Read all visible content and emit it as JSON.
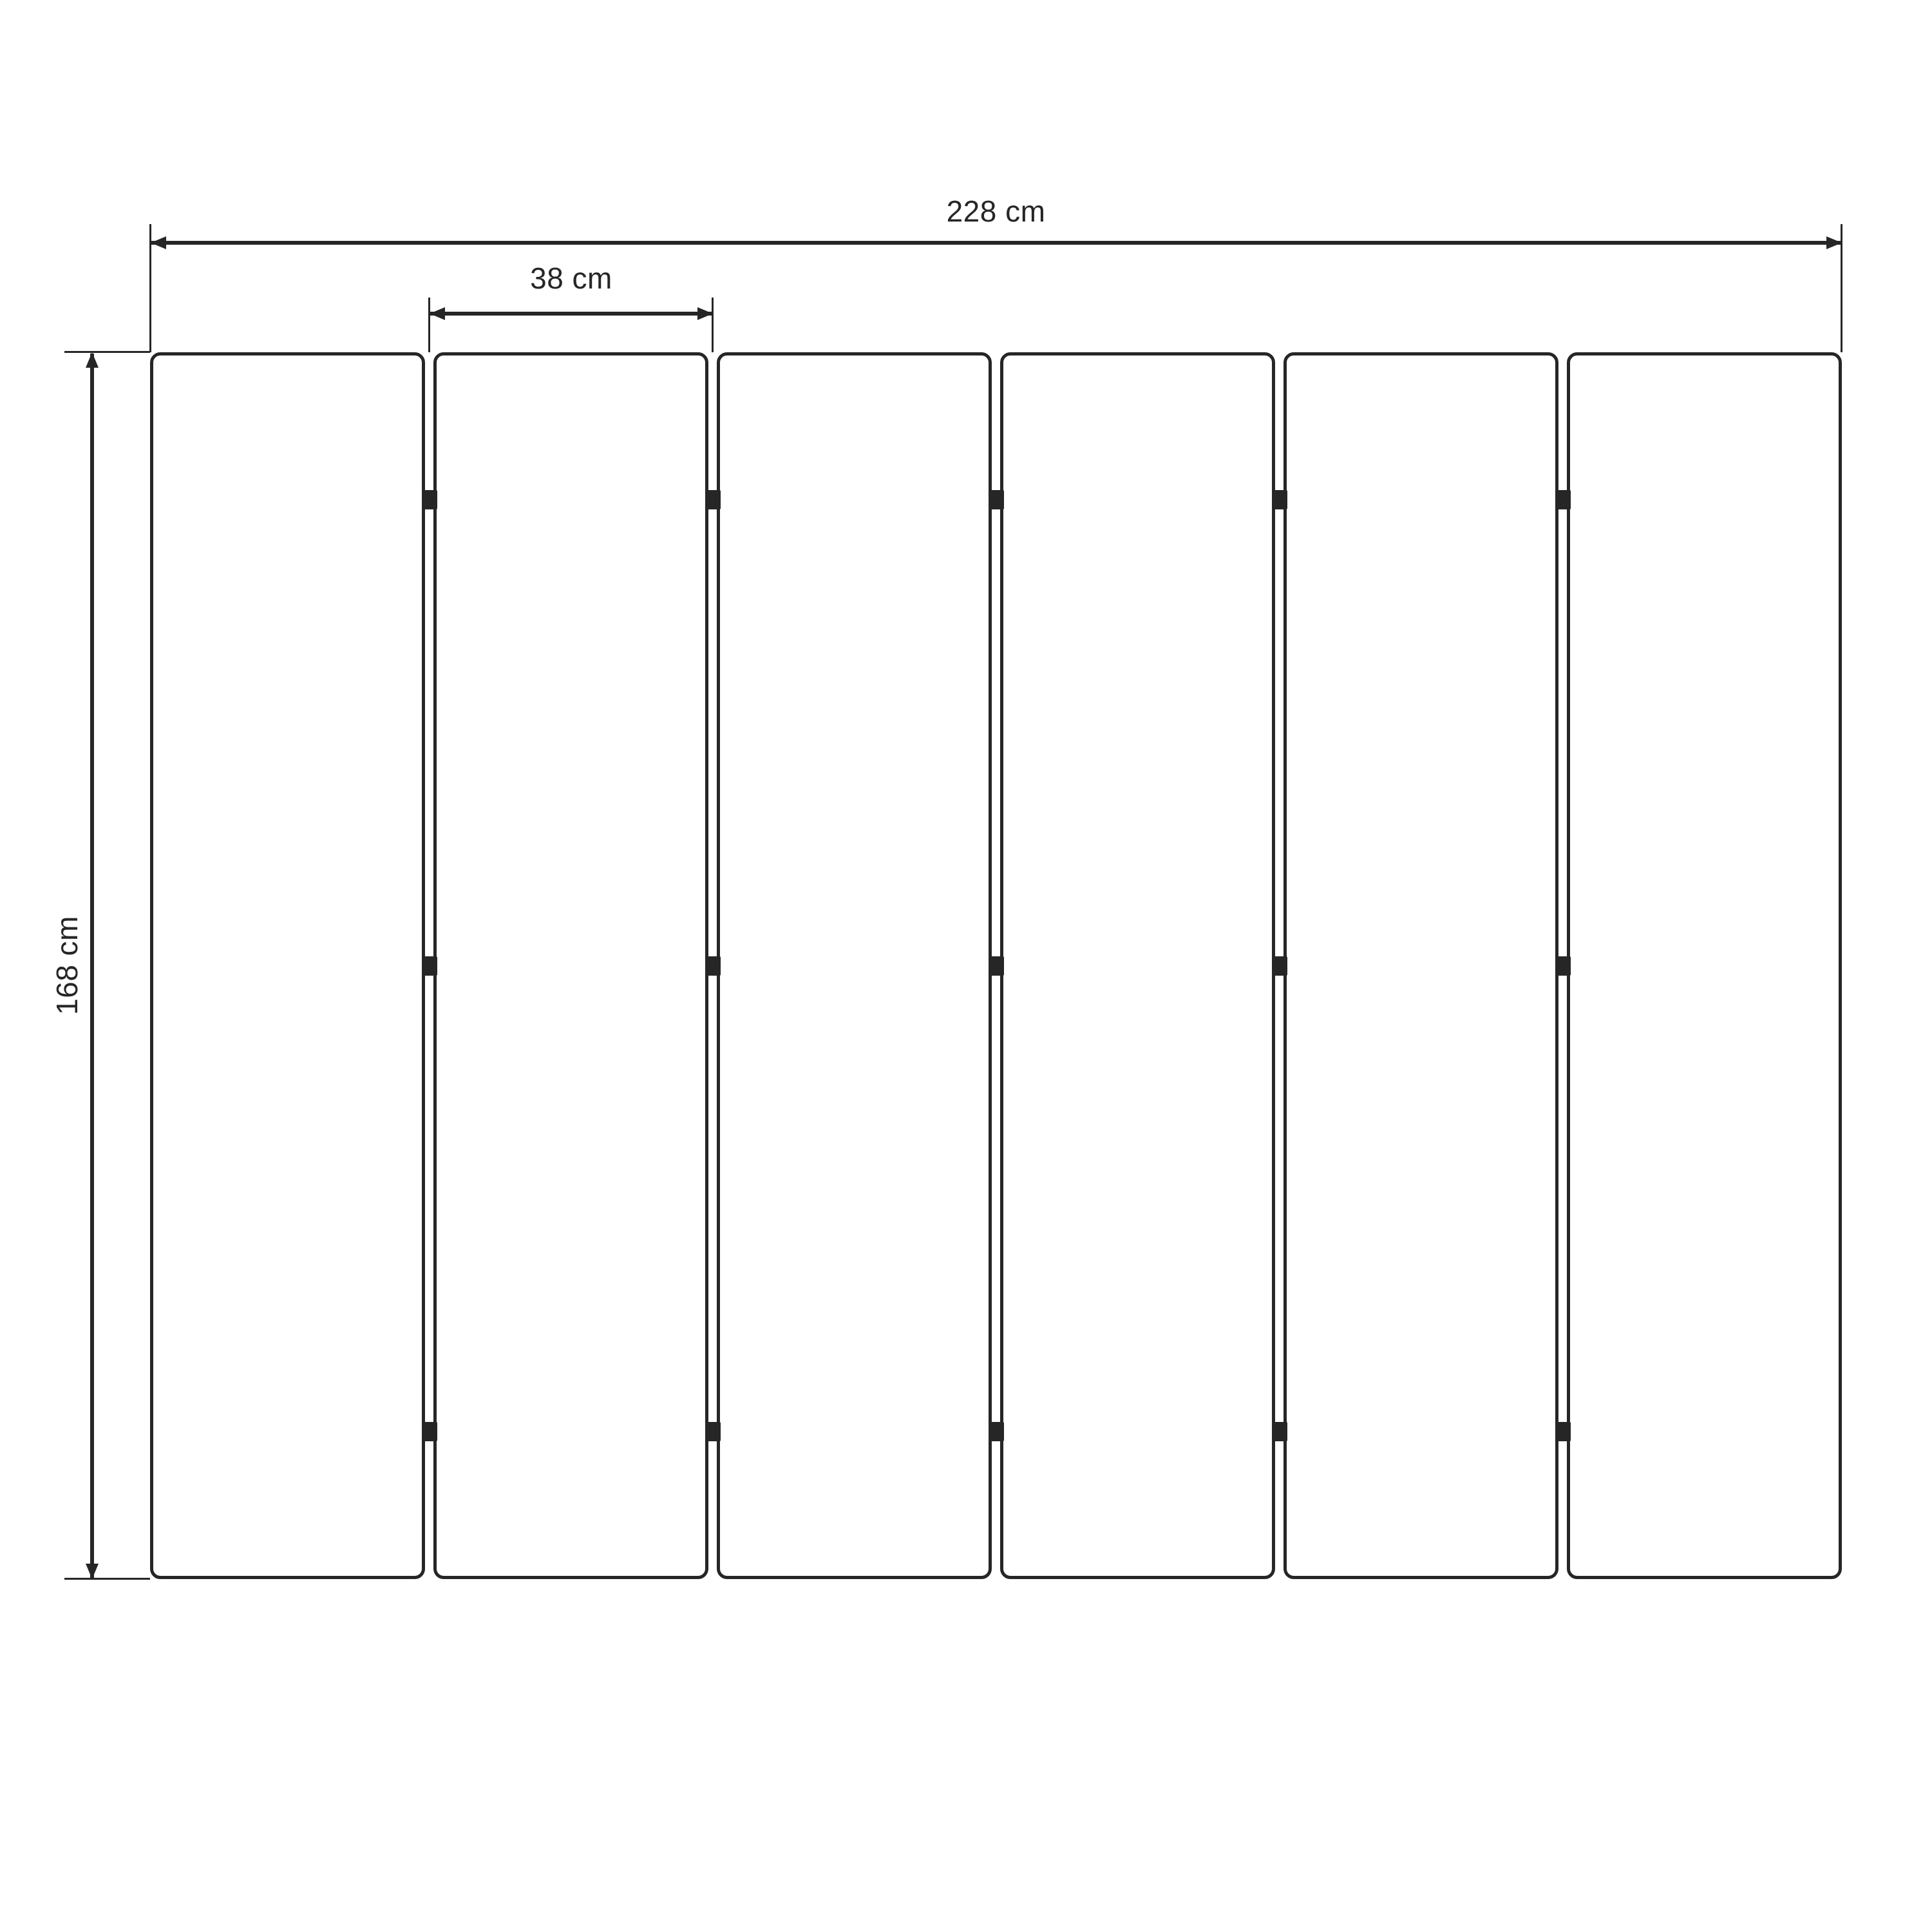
{
  "diagram": {
    "background_color": "#ffffff",
    "line_color": "#262626",
    "dimensions": {
      "total_width": {
        "label": "228 cm",
        "value": 228,
        "unit": "cm"
      },
      "panel_width": {
        "label": "38 cm",
        "value": 38,
        "unit": "cm"
      },
      "height": {
        "label": "168 cm",
        "value": 168,
        "unit": "cm"
      }
    },
    "panels": {
      "count": 6,
      "gaps": 5,
      "hinges_per_gap": 3,
      "hinge_position_fractions": [
        0.12,
        0.5,
        0.88
      ]
    }
  }
}
